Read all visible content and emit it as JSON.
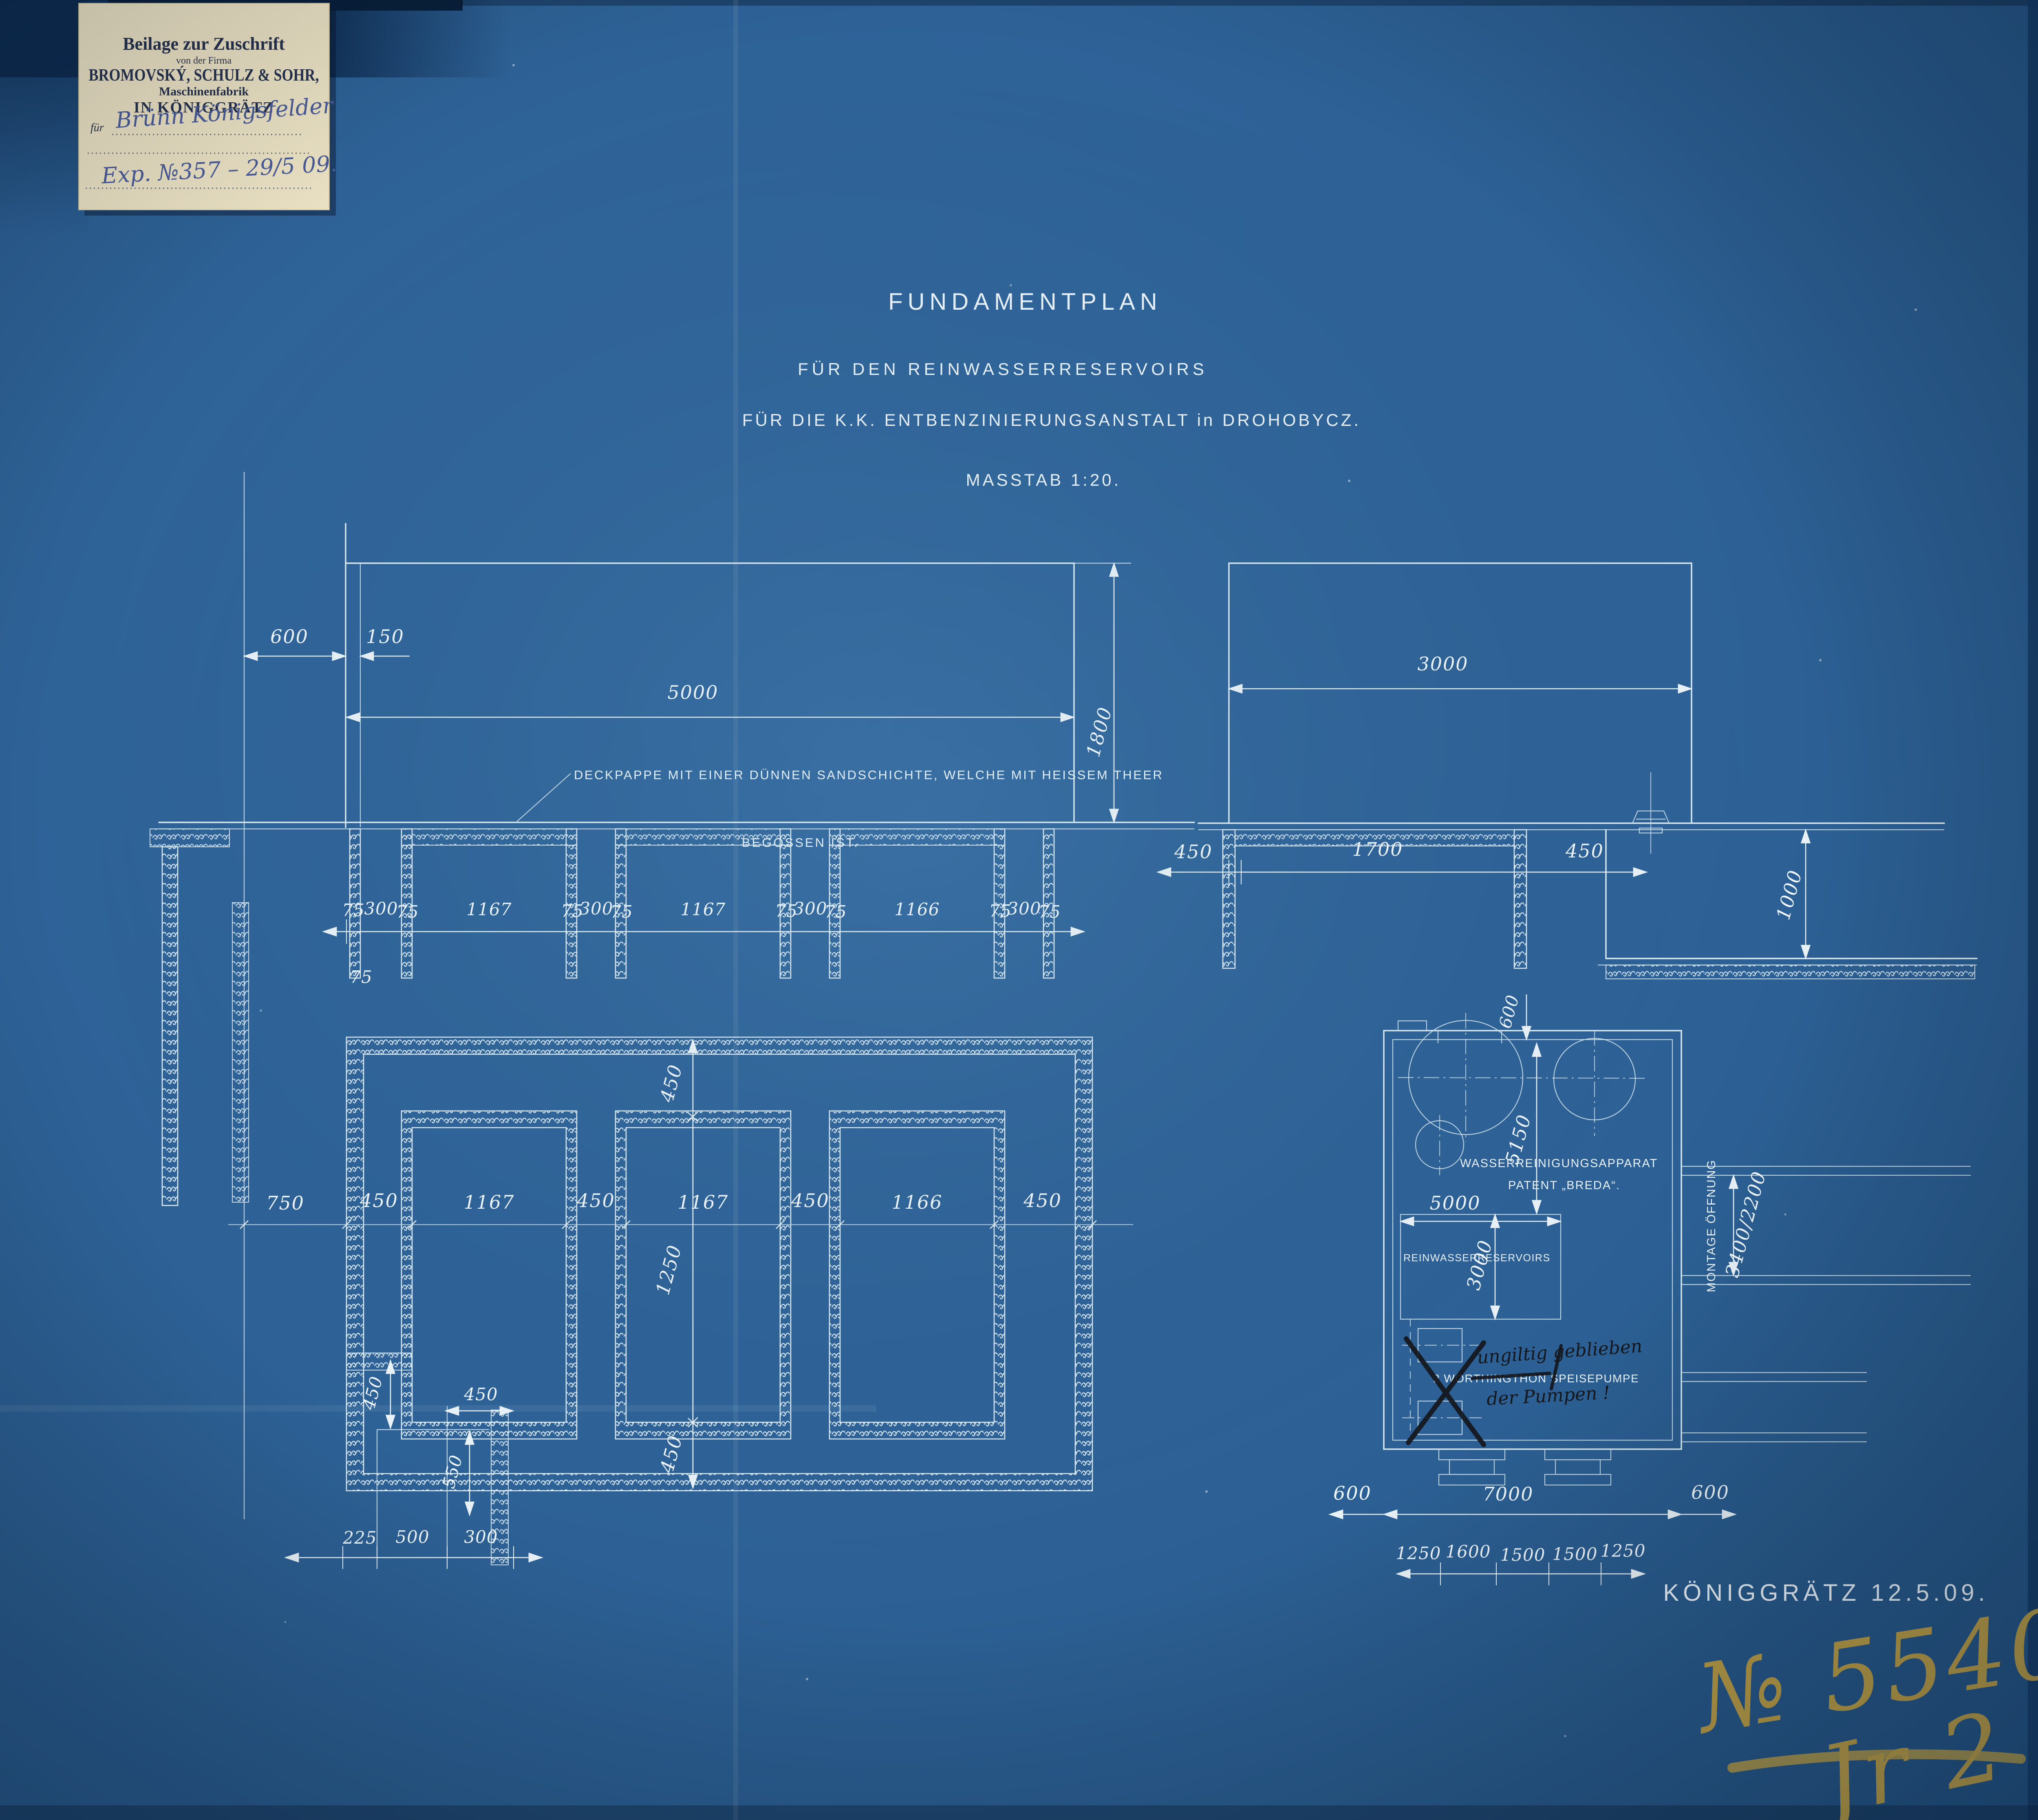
{
  "colors": {
    "paper_blue": "#2d6196",
    "paper_blue_edge": "#1e4a7a",
    "line_white": "#dcebf2",
    "label_paper": "#ece3c5",
    "label_ink": "#26324f",
    "hand_ink_blue": "#4a5c99",
    "crayon_yellow": "#c9a642",
    "ink_black": "#14171c"
  },
  "label_card": {
    "line1": "Beilage zur Zuschrift",
    "line2": "von der Firma",
    "line3": "BROMOVSKÝ, SCHULZ & SOHR,",
    "line4": "Maschinenfabrik",
    "line5": "IN KÖNIGGRÄTZ",
    "fuer_prefix": "für",
    "fuer_value": "Brünn Königsfelder",
    "exp_line": "Exp. №357 – 29/5 09."
  },
  "title_block": {
    "line1": "FUNDAMENTPLAN",
    "line2": "FÜR DEN REINWASSERRESERVOIRS",
    "line3": "FÜR DIE K.K. ENTBENZINIERUNGSANSTALT in DROHOBYCZ.",
    "scale": "MASSTAB 1:20."
  },
  "section_left": {
    "dim_600": "600",
    "dim_150": "150",
    "dim_5000": "5000",
    "dim_1800": "1800",
    "note_line1": "DECKPAPPE MIT EINER DÜNNEN SANDSCHICHTE, WELCHE MIT HEISSEM THEER",
    "note_line2": "BEGOSSEN IST.",
    "chain": [
      "75",
      "300",
      "75",
      "1167",
      "75",
      "300",
      "75",
      "1167",
      "75",
      "300",
      "75",
      "1166",
      "75",
      "300",
      "75"
    ],
    "extra_75": "75"
  },
  "section_right": {
    "dim_3000": "3000",
    "chain": [
      "450",
      "1700",
      "450"
    ],
    "dim_1000": "1000"
  },
  "plan_left": {
    "chain": [
      "750",
      "450",
      "1167",
      "450",
      "1167",
      "450",
      "1166",
      "450"
    ],
    "v_chain": [
      "450",
      "1250",
      "450"
    ],
    "dim_450_v": "450",
    "dim_450_h": "450",
    "dim_550": "550",
    "bottom_chain": [
      "225",
      "500",
      "300"
    ]
  },
  "plan_right": {
    "label_apparat_line1": "WASSERREINIGUNGSAPPARAT",
    "label_apparat_line2": "PATENT „BREDA“.",
    "label_reservoir": "REINWASSERRESERVOIRS",
    "dim_600_top": "600",
    "dim_5150": "5150",
    "dim_5000": "5000",
    "dim_3000": "3000",
    "pump_label": "2 WORTHINGTHON SPEISEPUMPE",
    "ink_note_line1": "ungiltig geblieben",
    "ink_note_line2": "der Pumpen !",
    "montage_label": "MONTAGE ÖFFNUNG",
    "montage_value": "3400/2200",
    "dim_7000": "7000",
    "dim_600_left": "600",
    "dim_600_right": "600",
    "bottom_chain": [
      "1250",
      "1600",
      "1500",
      "1500",
      "1250"
    ]
  },
  "footer": {
    "place_date": "KÖNIGGRÄTZ   12.5.09.",
    "drawing_number": "№ 5540",
    "drawing_number_sub": "Jr 2"
  }
}
